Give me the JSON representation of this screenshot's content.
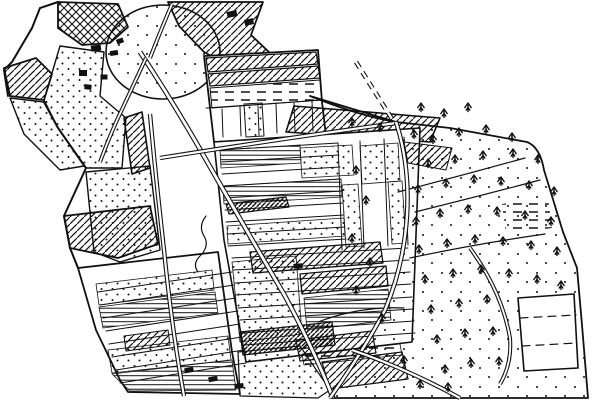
{
  "meta": {
    "title": "hand-drawn-field-map",
    "background_color": "#ffffff",
    "ink_color": "#111111",
    "width": 600,
    "height": 400
  },
  "map": {
    "regions": [
      {
        "n": "village-hatch-a",
        "d": "M58,2 L118,4 L128,27 L110,43 L82,45 L58,28 Z",
        "f": "cross",
        "sw": 1.8
      },
      {
        "n": "village-hatch-b",
        "d": "M168,2 L263,2 L251,35 L270,53 L242,73 L204,52 L179,26 Z",
        "f": "hatch",
        "sw": 1.8
      },
      {
        "n": "hill-oval",
        "d": "M106,52 A57,47 0 1 1 220,52 A57,47 0 1 1 106,52 Z",
        "f": "dotsSparse",
        "sw": 1.6
      },
      {
        "n": "left-parcel-hatch",
        "d": "M4,68 L36,58 L52,74 L44,100 L10,96 Z",
        "f": "hatch",
        "sw": 1.8
      },
      {
        "n": "village-dotted-west",
        "d": "M10,98 L44,102 L58,128 L84,166 L60,170 L24,134 Z",
        "f": "dots",
        "sw": 1.4
      },
      {
        "n": "village-dotted",
        "d": "M60,46 L104,52 L100,96 L126,118 L122,168 L86,168 L58,128 L44,100 Z",
        "f": "dots",
        "sw": 1.4
      },
      {
        "n": "midleft-dotted",
        "d": "M86,172 L150,166 L160,250 L120,262 L94,252 Z",
        "f": "dots",
        "sw": 1.4
      },
      {
        "n": "hatch-strip",
        "d": "M124,118 L142,112 L150,168 L132,174 Z",
        "f": "hatch",
        "sw": 1.6
      },
      {
        "n": "left-hatch-wedge",
        "d": "M64,216 L150,206 L158,244 L118,258 L70,248 Z",
        "f": "hatch",
        "sw": 1.8
      },
      {
        "n": "upper-block",
        "d": "M204,56 L318,50 L322,102 L326,136 L214,142 Z",
        "f": "white",
        "sw": 1.8
      },
      {
        "n": "upper-hatch-1",
        "d": "M206,58 L316,52 L318,64 L208,72 Z",
        "f": "hatch",
        "sw": 1.2
      },
      {
        "n": "upper-hatch-2",
        "d": "M208,74 L318,66 L320,78 L210,86 Z",
        "f": "hatch",
        "sw": 1.2
      },
      {
        "n": "upper-dashrows",
        "d": "M210,88 L320,80 L322,100 L212,108 Z",
        "f": "dashrows",
        "sw": 1
      },
      {
        "n": "upper-dotted-col",
        "d": "M244,104 L262,103 L264,136 L246,137 Z",
        "f": "dots",
        "sw": 1
      },
      {
        "n": "hatch-parallelogram",
        "d": "M294,106 L440,118 L430,142 L286,132 Z",
        "f": "hatch",
        "sw": 1.6
      },
      {
        "n": "central-block",
        "d": "M214,142 L420,128 L412,342 L246,362 L224,240 Z",
        "f": "white",
        "sw": 1.6
      },
      {
        "n": "strips-dotted-1",
        "d": "M300,148 L352,145 L354,175 L302,178 Z",
        "f": "dots",
        "sw": 0.8
      },
      {
        "n": "strips-dotted-2",
        "d": "M360,146 L398,143 L400,181 L362,184 Z",
        "f": "dots",
        "sw": 0.8
      },
      {
        "n": "strips-col-dotted-1",
        "d": "M342,185 L358,184 L362,246 L346,247 Z",
        "f": "dots",
        "sw": 0.8
      },
      {
        "n": "strips-col-dotted-2",
        "d": "M388,182 L402,181 L406,243 L392,244 Z",
        "f": "dots",
        "sw": 0.8
      },
      {
        "n": "strips-hlines-1",
        "d": "M220,150 L300,145 L301,163 L221,168 Z",
        "f": "hlines",
        "sw": 0.8
      },
      {
        "n": "strips-hlines-2",
        "d": "M223,186 L341,179 L342,197 L224,204 Z",
        "f": "hlines",
        "sw": 0.8
      },
      {
        "n": "dark-band",
        "d": "M226,204 L286,197 L289,207 L229,214 Z",
        "f": "hatchDense",
        "sw": 1.2
      },
      {
        "n": "strips-dotted-3",
        "d": "M227,226 L344,218 L345,236 L228,244 Z",
        "f": "dots",
        "sw": 0.8
      },
      {
        "n": "central-hatch-band-1",
        "d": "M250,252 L380,242 L383,263 L253,273 Z",
        "f": "hatch",
        "sw": 1.3
      },
      {
        "n": "central-hatch-band-2",
        "d": "M300,274 L386,266 L388,286 L302,294 Z",
        "f": "hatch",
        "sw": 1.3
      },
      {
        "n": "central-dotted-big",
        "d": "M232,262 L296,256 L302,334 L240,342 Z",
        "f": "dots",
        "sw": 0.8
      },
      {
        "n": "strips-hlines-3",
        "d": "M304,298 L388,289 L391,320 L307,330 Z",
        "f": "hlines",
        "sw": 0.8
      },
      {
        "n": "central-hatch-band-3",
        "d": "M240,332 L332,322 L335,345 L243,355 Z",
        "f": "hatchDense",
        "sw": 1.3
      },
      {
        "n": "lowerleft-block",
        "d": "M78,268 L218,252 L232,352 L240,394 L128,392 L120,380 L96,330 Z",
        "f": "white",
        "sw": 1.8
      },
      {
        "n": "lowerleft-dots-1",
        "d": "M96,284 L212,270 L214,290 L99,305 Z",
        "f": "dots",
        "sw": 0.8
      },
      {
        "n": "lowerleft-hlines-1",
        "d": "M99,307 L215,292 L218,313 L103,328 Z",
        "f": "hlines",
        "sw": 0.8
      },
      {
        "n": "lowerleft-hatch",
        "d": "M124,336 L168,330 L170,345 L126,351 Z",
        "f": "hatch",
        "sw": 1
      },
      {
        "n": "lowerleft-dots-2",
        "d": "M108,350 L228,336 L231,360 L112,373 Z",
        "f": "dots",
        "sw": 0.8
      },
      {
        "n": "lowerleft-hlines-2",
        "d": "M112,374 L232,360 L236,390 L130,391 Z",
        "f": "hlines",
        "sw": 0.8
      },
      {
        "n": "bottom-center-dotted",
        "d": "M238,352 L300,346 L330,390 L318,398 L240,396 Z",
        "f": "dots",
        "sw": 1.2
      },
      {
        "n": "woodland",
        "d": "M310,96 Q360,116 396,122 L450,128 L527,142 Q540,147 544,170 L563,232 L577,268 L582,325 L588,398 L330,398 Q364,350 385,310 Q404,265 407,215 Q410,165 396,122 Z",
        "f": "dotsSparse",
        "sw": 1.8
      },
      {
        "n": "woodland-hatch",
        "d": "M404,142 L452,148 L446,170 L408,163 Z",
        "f": "hatch",
        "sw": 1
      },
      {
        "n": "wood-dash-field",
        "d": "M502,204 L548,198 L552,228 L506,234 Z",
        "f": "dashrows",
        "sw": 0
      },
      {
        "n": "bottom-hatch-1",
        "d": "M296,340 L372,331 L376,353 L300,361 Z",
        "f": "hatch",
        "sw": 1.2
      },
      {
        "n": "bottom-dashrow",
        "d": "M302,354 L400,344 L402,355 L304,365 Z",
        "f": "dashrows",
        "sw": 0.8
      },
      {
        "n": "bottom-hatch-2",
        "d": "M322,362 L402,352 L408,379 L330,389 Z",
        "f": "hatch",
        "sw": 1.2
      },
      {
        "n": "dashed-parcel",
        "d": "M518,298 L574,294 L578,368 L524,371 Z",
        "f": "white",
        "sw": 1.6
      }
    ],
    "lines": [
      {
        "n": "outer-left-edge",
        "d": "M58,2 L40,8 L32,28 L12,62 L4,70 L8,96",
        "w": 2
      },
      {
        "n": "outer-left-edge-2",
        "d": "M44,102 L58,128 L86,168 L64,216 L70,248 L78,268",
        "w": 2
      },
      {
        "n": "upper-strip-dividers",
        "d": "M222,109 L223,137 M240,107 L241,136 M258,106 L259,135 M276,104 L277,133 M294,103 L295,132 M312,101 L313,131 M206,108 L322,100",
        "w": 1
      },
      {
        "n": "central-strips-upper",
        "d": "M220,150 L338,143 M221,162 L339,155 M222,174 L340,167 M223,186 L341,179 M224,198 L342,191 M225,210 L343,203 M226,222 L344,215 M227,234 L345,227 M228,246 L346,239",
        "w": 1
      },
      {
        "n": "central-strip-verticals",
        "d": "M338,143 L342,250 M360,141 L364,248 M384,139 L388,246 M404,137 L408,245",
        "w": 1
      },
      {
        "n": "central-strips-lower",
        "d": "M232,258 L408,248 M233,270 L409,260 M235,283 L410,272 M236,295 L411,284 M238,308 L412,297 M240,320 L413,309 M242,333 L414,321 M244,345 L415,333",
        "w": 1
      },
      {
        "n": "lowerleft-strips",
        "d": "M98,292 L232,272 M100,305 L234,285 M103,318 L236,298 M106,331 L238,311 M109,344 L240,324 M112,357 L242,337 M116,370 L244,350 M120,383 L246,363",
        "w": 1
      },
      {
        "n": "woodland-curves",
        "d": "M398,192 Q460,176 525,158 M410,258 Q475,244 545,234 M318,322 Q360,306 404,308 M415,212 Q480,196 540,180",
        "w": 1.2
      },
      {
        "n": "stream",
        "d": "M206,216 Q198,226 204,236 Q210,246 200,256 Q192,264 198,272",
        "w": 1.2
      },
      {
        "n": "dashed-parcel-inner",
        "d": "M520,318 L576,315 M522,346 L577,343",
        "w": 1.2,
        "dash": "8 6"
      }
    ],
    "roads": [
      {
        "n": "road-main-diagonal",
        "d": "M140,52 Q175,105 205,158 Q245,228 285,296 Q315,352 333,398",
        "w": 5
      },
      {
        "n": "road-left-vertical",
        "d": "M150,114 Q156,180 164,250 Q172,330 184,396",
        "w": 4.4
      },
      {
        "n": "road-top-horizontal",
        "d": "M160,158 Q260,142 396,123",
        "w": 4.4
      },
      {
        "n": "road-woodland",
        "d": "M396,122 Q410,165 407,215 Q404,265 385,310 Q364,350 330,398",
        "w": 4.6
      },
      {
        "n": "road-bottom-right",
        "d": "M352,350 Q405,368 460,398",
        "w": 4.4
      },
      {
        "n": "road-dashed",
        "d": "M356,62 L392,119",
        "w": 4.6,
        "dash": "7 5"
      },
      {
        "n": "road-village-sw",
        "d": "M146,58 Q130,92 118,118 Q108,140 100,162",
        "w": 4
      },
      {
        "n": "road-village-north",
        "d": "M150,58 Q160,32 172,4",
        "w": 4
      },
      {
        "n": "road-wood-east",
        "d": "M470,248 Q502,292 510,338 Q512,364 500,384",
        "w": 4
      }
    ],
    "buildings": [
      [
        96,
        48,
        10,
        6,
        -8
      ],
      [
        114,
        53,
        8,
        5,
        -8
      ],
      [
        83,
        73,
        8,
        6,
        0
      ],
      [
        104,
        77,
        7,
        5,
        0
      ],
      [
        88,
        87,
        7,
        5,
        6
      ],
      [
        120,
        41,
        7,
        5,
        -20
      ],
      [
        232,
        14,
        10,
        6,
        -12
      ],
      [
        249,
        22,
        9,
        6,
        -12
      ],
      [
        298,
        266,
        9,
        5,
        -4
      ],
      [
        189,
        370,
        9,
        5,
        -10
      ],
      [
        213,
        379,
        9,
        5,
        -10
      ],
      [
        239,
        386,
        9,
        5,
        -6
      ]
    ],
    "trees": [
      [
        352,
        122
      ],
      [
        380,
        127
      ],
      [
        421,
        107
      ],
      [
        444,
        113
      ],
      [
        468,
        107
      ],
      [
        414,
        134
      ],
      [
        433,
        139
      ],
      [
        459,
        132
      ],
      [
        486,
        129
      ],
      [
        512,
        137
      ],
      [
        356,
        170
      ],
      [
        428,
        163
      ],
      [
        455,
        159
      ],
      [
        483,
        155
      ],
      [
        513,
        153
      ],
      [
        538,
        159
      ],
      [
        366,
        200
      ],
      [
        418,
        189
      ],
      [
        446,
        183
      ],
      [
        474,
        179
      ],
      [
        501,
        181
      ],
      [
        529,
        185
      ],
      [
        554,
        191
      ],
      [
        352,
        238
      ],
      [
        416,
        221
      ],
      [
        440,
        213
      ],
      [
        468,
        209
      ],
      [
        497,
        211
      ],
      [
        525,
        215
      ],
      [
        551,
        221
      ],
      [
        370,
        262
      ],
      [
        419,
        249
      ],
      [
        447,
        243
      ],
      [
        475,
        239
      ],
      [
        503,
        241
      ],
      [
        531,
        245
      ],
      [
        557,
        251
      ],
      [
        356,
        290
      ],
      [
        425,
        279
      ],
      [
        453,
        273
      ],
      [
        481,
        269
      ],
      [
        509,
        273
      ],
      [
        537,
        279
      ],
      [
        561,
        285
      ],
      [
        382,
        318
      ],
      [
        431,
        309
      ],
      [
        459,
        303
      ],
      [
        487,
        299
      ],
      [
        437,
        339
      ],
      [
        465,
        333
      ],
      [
        493,
        331
      ],
      [
        404,
        360
      ],
      [
        445,
        369
      ],
      [
        471,
        363
      ],
      [
        499,
        361
      ],
      [
        420,
        384
      ],
      [
        448,
        387
      ]
    ]
  }
}
